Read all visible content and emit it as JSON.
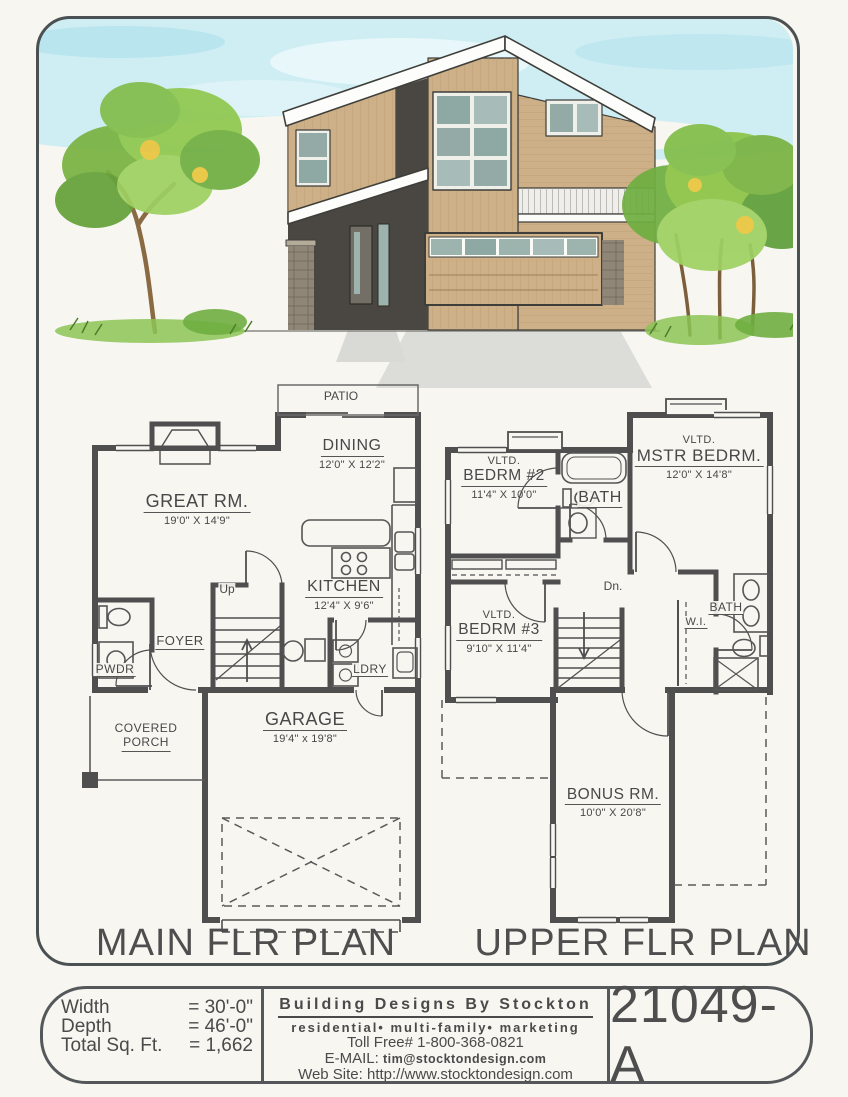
{
  "colors": {
    "paper": "#f7f6f1",
    "linework": "#4f4f4f",
    "border": "#4b5153",
    "sky": "#cfeef4",
    "siding_tan": "#cdb087",
    "accent_charcoal": "#4a4641",
    "window_glass": "#93aaa6",
    "stone": "#8f8677",
    "foliage_green": "#8cc447",
    "trunk_brown": "#8a6a42",
    "driveway": "#dcdcd9"
  },
  "illustration": {
    "alt": "Watercolor front elevation of a two-story modern house with trees and shrubs"
  },
  "main_plan": {
    "title": "MAIN FLR PLAN",
    "patio": "PATIO",
    "up": "Up",
    "foyer": "FOYER",
    "pwdr": "PWDR",
    "ldry": "LDRY",
    "covered_porch": {
      "line1": "COVERED",
      "line2": "PORCH"
    },
    "rooms": {
      "great": {
        "name": "GREAT RM.",
        "dims": "19'0\" X 14'9\""
      },
      "dining": {
        "name": "DINING",
        "dims": "12'0\" X 12'2\""
      },
      "kitchen": {
        "name": "KITCHEN",
        "dims": "12'4\" X 9'6\""
      },
      "garage": {
        "name": "GARAGE",
        "dims": "19'4\" x 19'8\""
      }
    }
  },
  "upper_plan": {
    "title": "UPPER FLR PLAN",
    "dn": "Dn.",
    "wi": "W.I.",
    "bath_upper": "BATH",
    "bath_lower": "BATH",
    "rooms": {
      "bedrm2": {
        "vltd": "VLTD.",
        "name": "BEDRM #2",
        "dims": "11'4\" X 10'0\""
      },
      "mstr": {
        "vltd": "VLTD.",
        "name": "MSTR BEDRM.",
        "dims": "12'0\" X 14'8\""
      },
      "bedrm3": {
        "vltd": "VLTD.",
        "name": "BEDRM #3",
        "dims": "9'10\" X 11'4\""
      },
      "bonus": {
        "name": "BONUS RM.",
        "dims": "10'0\" X 20'8\""
      }
    }
  },
  "footer": {
    "stats": {
      "width_label": "Width",
      "width_value": "= 30'-0\"",
      "depth_label": "Depth",
      "depth_value": "= 46'-0\"",
      "sqft_label": "Total Sq. Ft.",
      "sqft_value": "= 1,662"
    },
    "company": {
      "name": "Building Designs By Stockton",
      "tagline": "residential• multi-family• marketing",
      "toll_free": "Toll Free#  1-800-368-0821",
      "email_label": "E-MAIL:",
      "email": "tim@stocktondesign.com",
      "web_label": "Web Site:",
      "web": "http://www.stocktondesign.com"
    },
    "plan_number": "21049-A"
  }
}
